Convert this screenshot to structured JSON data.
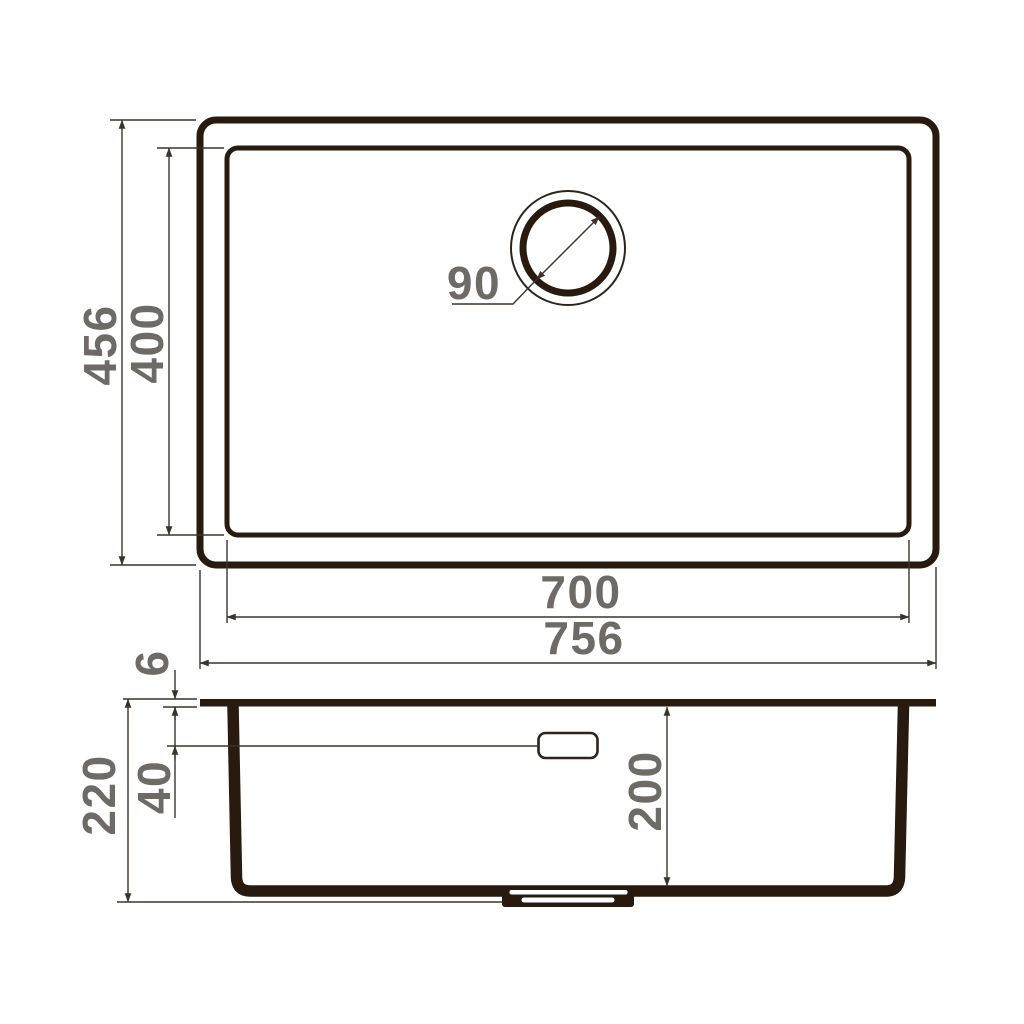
{
  "diagram_title": "Kitchen sink dimensional drawing (top view and side section view)",
  "colors": {
    "line": "#281a0e",
    "thin_line": "#3b332c",
    "label": "#6e6a66",
    "background": "#ffffff"
  },
  "top_view": {
    "outer_width_label": "756",
    "inner_width_label": "700",
    "outer_height_label": "456",
    "inner_height_label": "400",
    "drain_diameter_label": "90"
  },
  "side_view": {
    "total_depth_label": "220",
    "bowl_depth_label": "200",
    "rim_thickness_label": "6",
    "overflow_level_label": "40"
  }
}
